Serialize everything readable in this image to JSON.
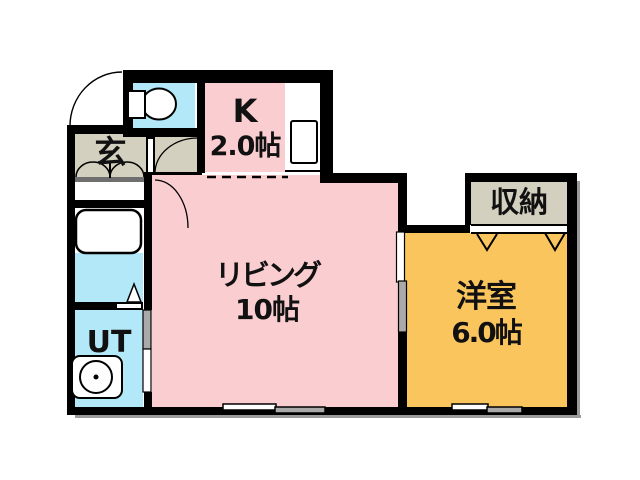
{
  "plan": {
    "type": "floorplan",
    "rooms": {
      "entrance": {
        "label": "玄"
      },
      "kitchen": {
        "label": "K",
        "size": "2.0帖"
      },
      "living": {
        "label": "リビング",
        "size": "10帖"
      },
      "western_room": {
        "label": "洋室",
        "size": "6.0帖"
      },
      "storage": {
        "label": "収納"
      },
      "utility": {
        "label": "UT"
      }
    },
    "fixtures": [
      "toilet-icon",
      "bathtub-icon",
      "washing-machine-icon",
      "kitchen-sink-icon",
      "door-swing-arc-icon",
      "sliding-door-icon",
      "window-icon",
      "closet-chevron-icon"
    ],
    "colors": {
      "room_pink": "#facdd1",
      "room_cyan": "#b2e8f7",
      "room_beige": "#d4d0bf",
      "room_orange": "#fbc55e",
      "wall_black": "#000000",
      "fitting_gray": "#a9a9a9",
      "background": "#ffffff"
    }
  }
}
